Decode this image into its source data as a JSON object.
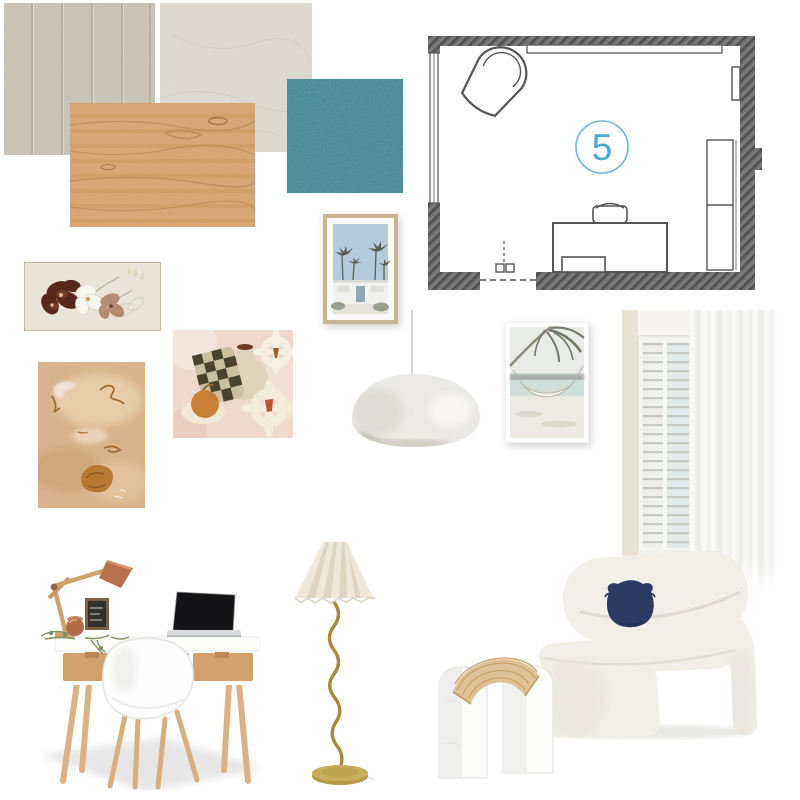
{
  "board": {
    "type": "interior-design-mood-board",
    "background_color": "#ffffff",
    "floorplan": {
      "room_number": "5",
      "room_number_color": "#4fa8d0",
      "circle_color": "#74b4d4",
      "wall_color": "#6e6e6e",
      "furniture_shown": [
        "armchair",
        "window",
        "top-bulkhead",
        "desk",
        "desk-chair",
        "wardrobe",
        "door"
      ]
    },
    "swatches": [
      {
        "name": "wall-panelling",
        "label": "Beige vertical wall panelling",
        "color": "#c8c2b5"
      },
      {
        "name": "stone-render",
        "label": "Warm white stone / render texture",
        "color": "#dcd8cf"
      },
      {
        "name": "timber",
        "label": "Light oak timber grain",
        "color": "#d6a472"
      },
      {
        "name": "carpet",
        "label": "Teal carpet",
        "color": "#45889b"
      }
    ],
    "artworks": [
      {
        "name": "orchid-artwork",
        "label": "Framed landscape print of brown, white and blush orchids",
        "colors": [
          "#58281d",
          "#f8f6f1",
          "#b48a74",
          "#e9e3d8"
        ]
      },
      {
        "name": "palm-springs-print",
        "label": "Framed print of white house with palm trees under pale blue sky",
        "colors": [
          "#b5cadb",
          "#f0f0ee",
          "#c9b493"
        ]
      },
      {
        "name": "still-life-print",
        "label": "Abstract still life with checkered cloth, vase, daisies and orange",
        "colors": [
          "#eed9cd",
          "#49432e",
          "#ded2bd",
          "#bf5327"
        ]
      },
      {
        "name": "beige-abstract-print",
        "label": "Beige and rust abstract painting",
        "colors": [
          "#d8b28a",
          "#b5772f",
          "#f0e6d8"
        ]
      },
      {
        "name": "hammock-print",
        "label": "White framed photo of hammock under palm tree on beach",
        "colors": [
          "#e8ebe7",
          "#cfe0dc",
          "#76796a"
        ]
      }
    ],
    "lighting": [
      {
        "name": "pendant-light",
        "label": "White textured dome pendant light",
        "color": "#eceae6"
      },
      {
        "name": "floor-lamp",
        "label": "Pleated cream shade floor lamp with wavy brass stem",
        "colors": [
          "#efe8da",
          "#a68a3e"
        ]
      }
    ],
    "furniture": [
      {
        "name": "desk-setting",
        "label": "White and oak desk with task lamp, laptop and white scandi chair",
        "colors": [
          "#fdfdfc",
          "#d2a26e",
          "#b5714e",
          "#141416"
        ]
      },
      {
        "name": "boucle-chair",
        "label": "Sculptural white boucle lounge chair with navy cushion",
        "colors": [
          "#f2efe9",
          "#2d3b64"
        ]
      }
    ],
    "decor": [
      {
        "name": "curtain-shutters",
        "label": "Sheer white curtains with plantation shutters",
        "colors": [
          "#fdfdfd",
          "#e9e1d2"
        ]
      },
      {
        "name": "marble-bookends",
        "label": "White marble arch bookends with woven raffia fan",
        "colors": [
          "#fbfbfa",
          "#ddc094"
        ]
      }
    ]
  }
}
